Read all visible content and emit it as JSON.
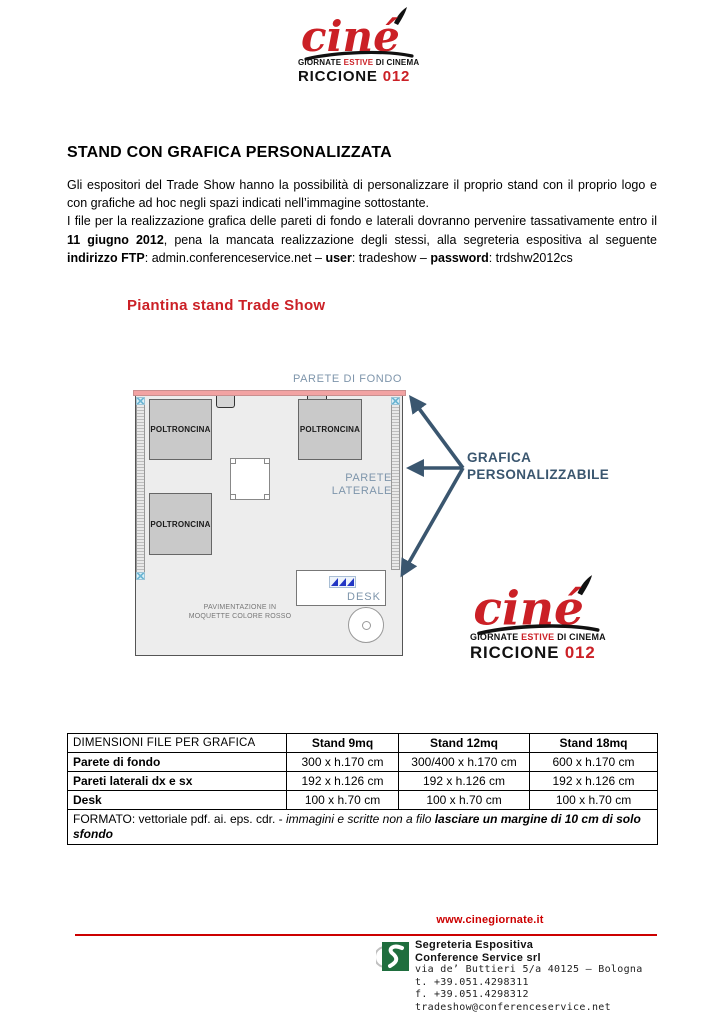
{
  "logo": {
    "script": "ciné",
    "tagline_pre": "GIORNATE ",
    "tagline_red": "ESTIVE",
    "tagline_post": " DI CINEMA",
    "city": "RICCIONE",
    "year": "012"
  },
  "heading": "STAND CON GRAFICA PERSONALIZZATA",
  "intro": {
    "p1": "Gli espositori del Trade Show hanno la possibilità di personalizzare il proprio stand con il proprio logo e con grafiche ad hoc negli spazi indicati nell’immagine sottostante.",
    "p2_a": "I file per la realizzazione grafica delle pareti di fondo e laterali dovranno pervenire tassativamente entro il ",
    "p2_b": "11 giugno 2012",
    "p2_c": ", pena la mancata realizzazione degli stessi, alla segreteria espositiva al seguente ",
    "p2_d": "indirizzo FTP",
    "p2_e": ": admin.conferenceservice.net – ",
    "p2_f": "user",
    "p2_g": ": tradeshow – ",
    "p2_h": "password",
    "p2_i": ": trdshw2012cs"
  },
  "diagram": {
    "title": "Piantina stand Trade Show",
    "parete_di_fondo": "PARETE DI FONDO",
    "parete_laterale_line1": "PARETE",
    "parete_laterale_line2": "LATERALE",
    "poltroncina": "POLTRONCINA",
    "desk": "DESK",
    "pavimentazione_line1": "PAVIMENTAZIONE IN",
    "pavimentazione_line2": "MOQUETTE COLORE ROSSO",
    "grafica_line1": "GRAFICA",
    "grafica_line2": "PERSONALIZZABILE"
  },
  "table": {
    "header": [
      "DIMENSIONI FILE PER GRAFICA",
      "Stand 9mq",
      "Stand 12mq",
      "Stand 18mq"
    ],
    "rows": [
      {
        "label": "Parete di fondo",
        "values": [
          "300 x h.170 cm",
          "300/400 x h.170 cm",
          "600 x h.170 cm"
        ]
      },
      {
        "label": "Pareti laterali dx e sx",
        "values": [
          "192 x h.126 cm",
          "192 x h.126 cm",
          "192 x h.126 cm"
        ]
      },
      {
        "label": "Desk",
        "values": [
          "100 x h.70 cm",
          "100 x h.70 cm",
          "100 x h.70 cm"
        ]
      }
    ],
    "formato_normal": "FORMATO: vettoriale pdf. ai. eps. cdr. - ",
    "formato_italic": "immagini e scritte non a filo ",
    "formato_bold_italic": "lasciare un margine di 10 cm di solo sfondo"
  },
  "footer": {
    "website": "www.cinegiornate.it",
    "org1": "Segreteria Espositiva",
    "org2": "Conference Service srl",
    "address": "via de’ Buttieri 5/a 40125 – Bologna",
    "tel": "t. +39.051.4298311",
    "fax": "f. +39.051.4298312",
    "email": "tradeshow@conferenceservice.net"
  },
  "colors": {
    "brand_red": "#cb2026",
    "wall_pink": "#f2a3a3",
    "label_blue": "#7e95ab",
    "arrow_blue": "#3a566f",
    "desk_logo_blue": "#2236c4",
    "footer_red": "#cc0000",
    "cs_green": "#1f6e3e"
  }
}
